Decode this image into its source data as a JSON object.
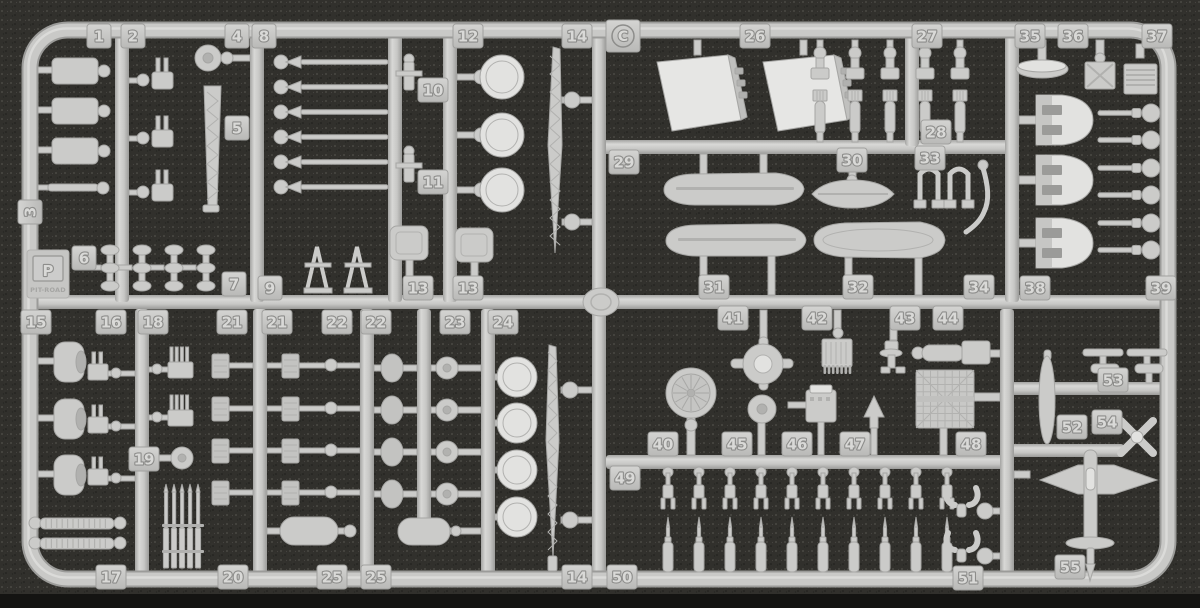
{
  "image": {
    "type": "photograph",
    "subject": "injection-molded plastic model kit parts sprue (runner C) with numbered part tags",
    "width": 1200,
    "height": 608
  },
  "sprue": {
    "gate_letter": "C",
    "brand": {
      "initial": "P",
      "name": "PIT-ROAD"
    },
    "colors": {
      "plastic": "#cbcbc9",
      "plastic_light": "#e2e2e0",
      "plastic_dark": "#b1b1af",
      "plastic_edge": "#a6a6a4",
      "emboss_text": "#d9d9d7",
      "emboss_shadow": "#8d8d8b",
      "background": "#31302c",
      "speckle_light": "#52514a",
      "speckle_dark": "#1d1d1a",
      "bottom_band": "#141412"
    },
    "part_tags": [
      {
        "label": "1",
        "x": 99,
        "y": 36
      },
      {
        "label": "2",
        "x": 133,
        "y": 36
      },
      {
        "label": "4",
        "x": 237,
        "y": 36
      },
      {
        "label": "8",
        "x": 264,
        "y": 36
      },
      {
        "label": "12",
        "x": 468,
        "y": 36
      },
      {
        "label": "14",
        "x": 577,
        "y": 36
      },
      {
        "label": "26",
        "x": 755,
        "y": 36
      },
      {
        "label": "27",
        "x": 927,
        "y": 36
      },
      {
        "label": "35",
        "x": 1030,
        "y": 36
      },
      {
        "label": "36",
        "x": 1073,
        "y": 36
      },
      {
        "label": "37",
        "x": 1157,
        "y": 36
      },
      {
        "label": "3",
        "x": 30,
        "y": 212,
        "rot": -90
      },
      {
        "label": "5",
        "x": 237,
        "y": 128
      },
      {
        "label": "6",
        "x": 84,
        "y": 258
      },
      {
        "label": "7",
        "x": 234,
        "y": 284
      },
      {
        "label": "9",
        "x": 270,
        "y": 288
      },
      {
        "label": "10",
        "x": 433,
        "y": 90
      },
      {
        "label": "11",
        "x": 433,
        "y": 182
      },
      {
        "label": "13",
        "x": 418,
        "y": 288
      },
      {
        "label": "13",
        "x": 468,
        "y": 288
      },
      {
        "label": "29",
        "x": 624,
        "y": 162
      },
      {
        "label": "30",
        "x": 852,
        "y": 160
      },
      {
        "label": "33",
        "x": 930,
        "y": 158
      },
      {
        "label": "28",
        "x": 936,
        "y": 132
      },
      {
        "label": "31",
        "x": 714,
        "y": 287
      },
      {
        "label": "32",
        "x": 858,
        "y": 287
      },
      {
        "label": "34",
        "x": 979,
        "y": 287
      },
      {
        "label": "38",
        "x": 1035,
        "y": 288
      },
      {
        "label": "39",
        "x": 1161,
        "y": 288
      },
      {
        "label": "15",
        "x": 36,
        "y": 322
      },
      {
        "label": "16",
        "x": 111,
        "y": 322
      },
      {
        "label": "18",
        "x": 153,
        "y": 322
      },
      {
        "label": "21",
        "x": 232,
        "y": 322
      },
      {
        "label": "21",
        "x": 277,
        "y": 322
      },
      {
        "label": "22",
        "x": 337,
        "y": 322
      },
      {
        "label": "22",
        "x": 376,
        "y": 322
      },
      {
        "label": "23",
        "x": 455,
        "y": 322
      },
      {
        "label": "24",
        "x": 503,
        "y": 322
      },
      {
        "label": "19",
        "x": 144,
        "y": 459
      },
      {
        "label": "17",
        "x": 111,
        "y": 577
      },
      {
        "label": "20",
        "x": 233,
        "y": 577
      },
      {
        "label": "25",
        "x": 332,
        "y": 577
      },
      {
        "label": "25",
        "x": 376,
        "y": 577
      },
      {
        "label": "14",
        "x": 577,
        "y": 577
      },
      {
        "label": "41",
        "x": 733,
        "y": 318
      },
      {
        "label": "42",
        "x": 817,
        "y": 318
      },
      {
        "label": "43",
        "x": 905,
        "y": 318
      },
      {
        "label": "44",
        "x": 948,
        "y": 318
      },
      {
        "label": "40",
        "x": 663,
        "y": 444
      },
      {
        "label": "45",
        "x": 737,
        "y": 444
      },
      {
        "label": "46",
        "x": 797,
        "y": 444
      },
      {
        "label": "47",
        "x": 855,
        "y": 444
      },
      {
        "label": "48",
        "x": 971,
        "y": 444
      },
      {
        "label": "49",
        "x": 625,
        "y": 478
      },
      {
        "label": "50",
        "x": 622,
        "y": 577
      },
      {
        "label": "51",
        "x": 968,
        "y": 578
      },
      {
        "label": "52",
        "x": 1072,
        "y": 427
      },
      {
        "label": "53",
        "x": 1113,
        "y": 380
      },
      {
        "label": "54",
        "x": 1107,
        "y": 422
      },
      {
        "label": "55",
        "x": 1070,
        "y": 567
      }
    ],
    "parts_legend": [
      "superstructure-blocks",
      "twin-aa-gun-mounts",
      "lattice-masts",
      "radar-platform-discs",
      "turret-roofs",
      "gun-turret-shields",
      "gun-barrels",
      "ship-boats",
      "davits",
      "vents",
      "searchlight",
      "radar-dish",
      "bedspring-radar-panel",
      "deck-hatches",
      "ammo-lockers",
      "small-deck-guns",
      "floatplane",
      "propellers",
      "float-wing-assemblies"
    ]
  }
}
